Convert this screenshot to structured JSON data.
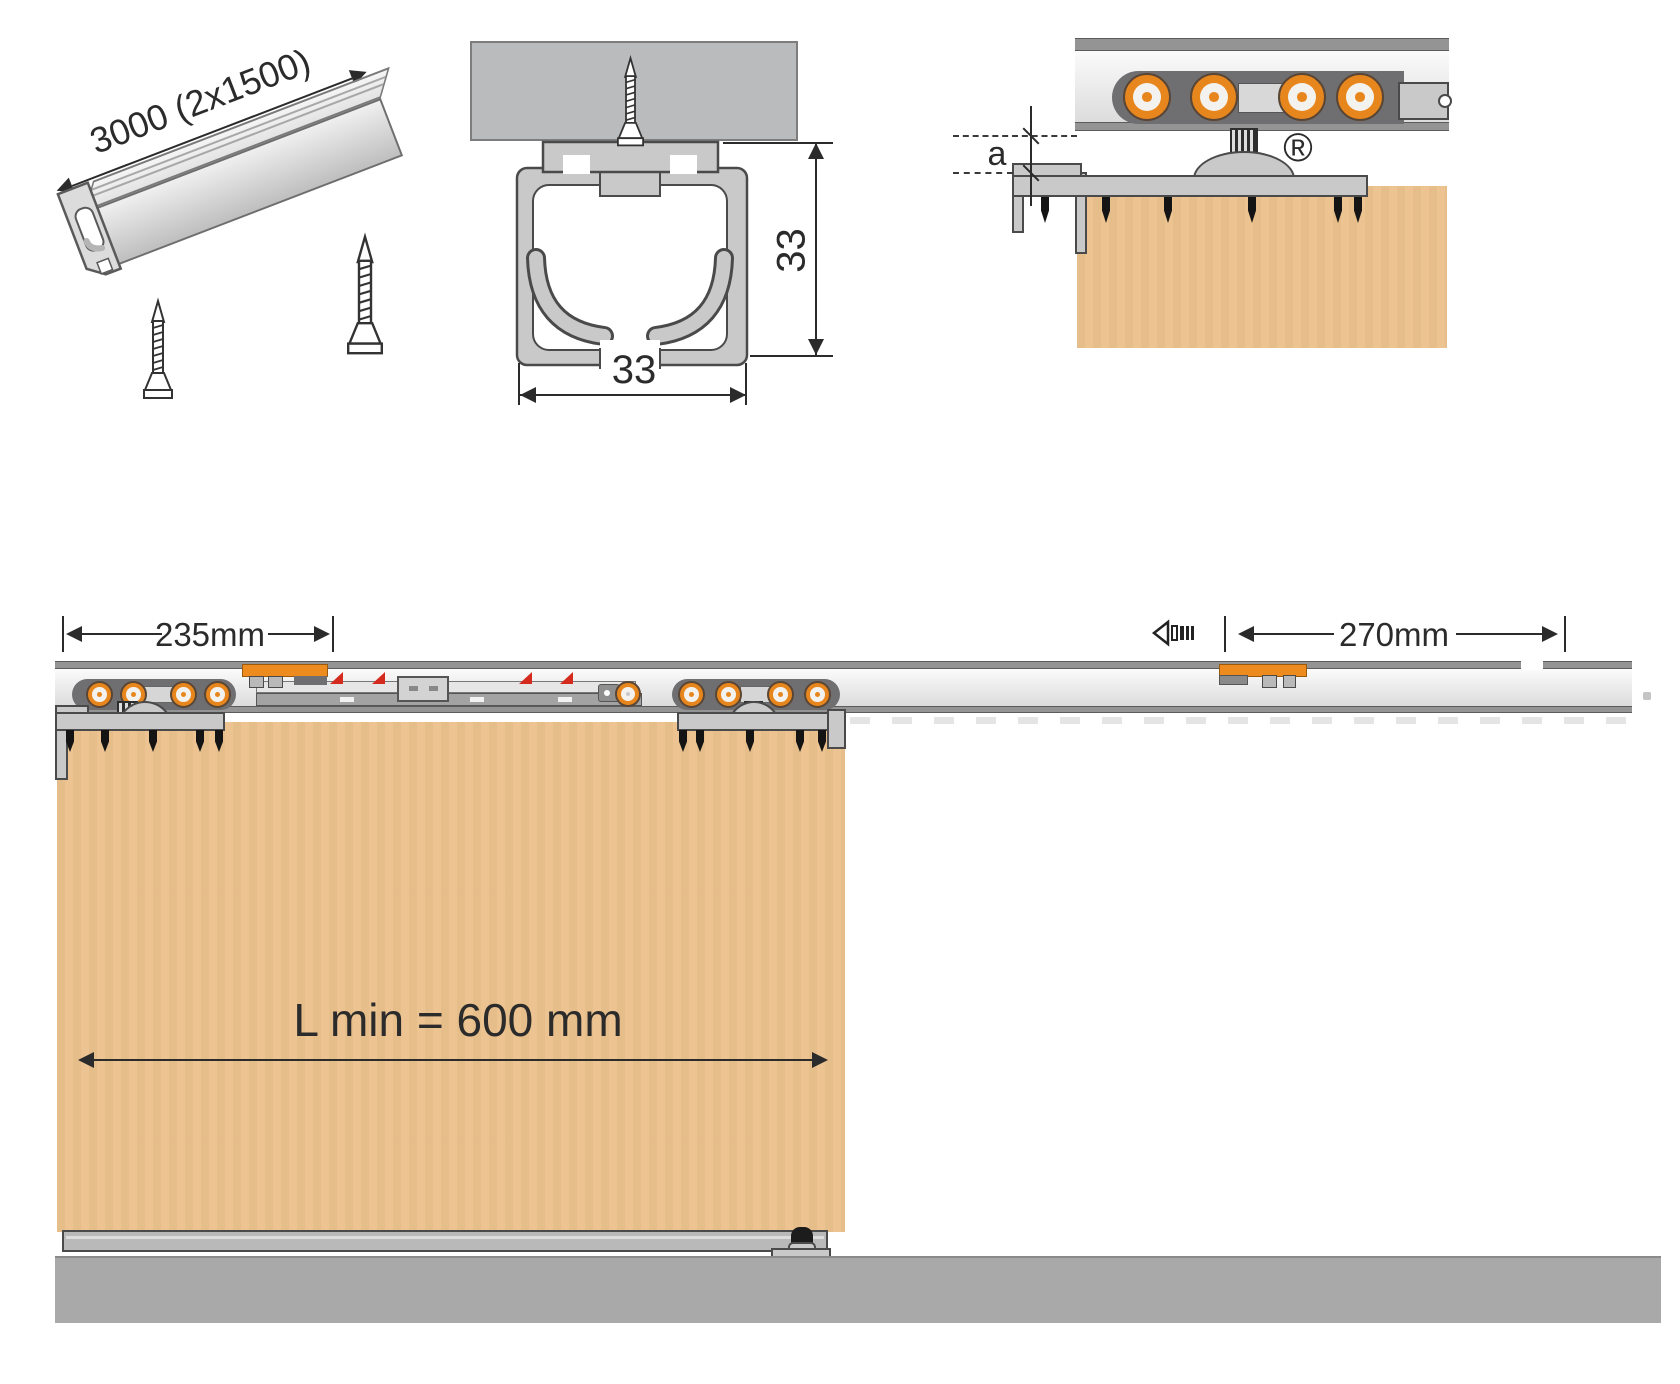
{
  "colors": {
    "roller_orange": "#E8861E",
    "activator_orange": "#EE8B1F",
    "door_tan": "#ECC28D",
    "floor_gray": "#A9A9A9",
    "ceiling_panel_gray": "#BABBBD",
    "soft_close_catch_red": "#D52B1E"
  },
  "iso_view": {
    "length_dim": "3000 (2x1500)"
  },
  "section_view": {
    "height_dim": "33",
    "width_dim": "33"
  },
  "detail_view": {
    "gap_dim": "a",
    "registered_mark": "®"
  },
  "elevation_view": {
    "track_left_dim": "235mm",
    "track_right_dim": "270mm",
    "door_min_length_dim": "L min = 600 mm"
  }
}
